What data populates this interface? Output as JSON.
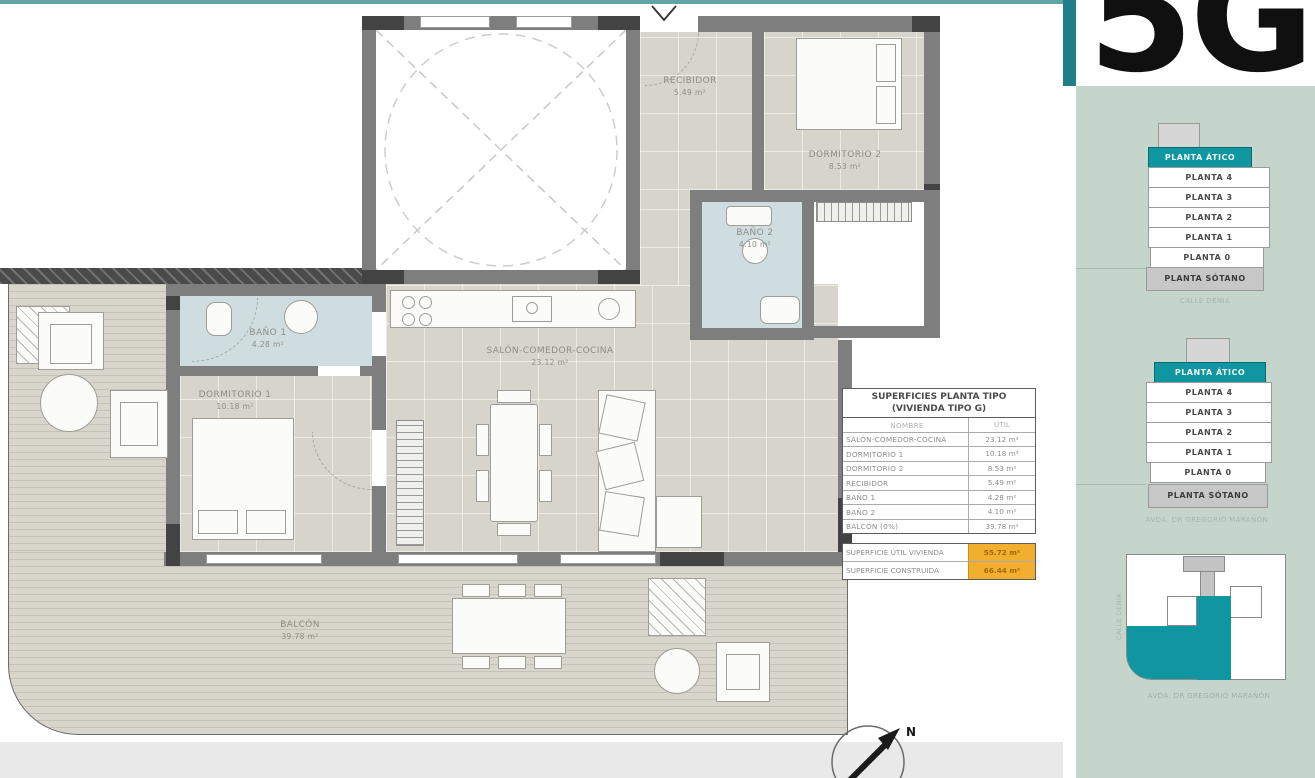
{
  "unit": {
    "code": "5G"
  },
  "plan": {
    "rooms": {
      "salon": {
        "label": "SALÓN-COMEDOR-COCINA",
        "area": "23.12 m²"
      },
      "dormitorio1": {
        "label": "DORMITORIO 1",
        "area": "10.18 m²"
      },
      "dormitorio2": {
        "label": "DORMITORIO 2",
        "area": "8.53 m²"
      },
      "recibidor": {
        "label": "RECIBIDOR",
        "area": "5.49 m²"
      },
      "bano1": {
        "label": "BAÑO 1",
        "area": "4.28 m²"
      },
      "bano2": {
        "label": "BAÑO 2",
        "area": "4.10 m²"
      },
      "balcon": {
        "label": "BALCÓN",
        "area": "39.78 m²"
      }
    },
    "compass_label": "N"
  },
  "surfaces_table": {
    "title_line1": "SUPERFICIES PLANTA TIPO",
    "title_line2": "(VIVIENDA TIPO G)",
    "col_name": "NOMBRE",
    "col_util": "ÚTIL",
    "rows": [
      {
        "name": "SALÓN-COMEDOR-COCINA",
        "util": "23.12 m²"
      },
      {
        "name": "DORMITORIO 1",
        "util": "10.18 m²"
      },
      {
        "name": "DORMITORIO 2",
        "util": "8.53 m²"
      },
      {
        "name": "RECIBIDOR",
        "util": "5.49 m²"
      },
      {
        "name": "BAÑO 1",
        "util": "4.28 m²"
      },
      {
        "name": "BAÑO 2",
        "util": "4.10 m²"
      },
      {
        "name": "BALCÓN (0%)",
        "util": "39.78 m²"
      }
    ],
    "totals": [
      {
        "name": "SUPERFICIE ÚTIL VIVIENDA",
        "value": "55.72 m²"
      },
      {
        "name": "SUPERFICIE CONSTRUIDA",
        "value": "66.44 m²"
      }
    ]
  },
  "sidebar": {
    "stack1": {
      "atico": "PLANTA ÁTICO",
      "floors": [
        "PLANTA 4",
        "PLANTA 3",
        "PLANTA 2",
        "PLANTA 1",
        "PLANTA 0"
      ],
      "sotano": "PLANTA SÓTANO",
      "caption": "CALLE DENIA"
    },
    "stack2": {
      "atico": "PLANTA ÁTICO",
      "floors": [
        "PLANTA 4",
        "PLANTA 3",
        "PLANTA 2",
        "PLANTA 1",
        "PLANTA 0"
      ],
      "sotano": "PLANTA SÓTANO",
      "caption": "AVDA. DR GREGORIO MARAÑÓN"
    },
    "siteplan": {
      "street_left": "CALLE DENIA",
      "street_bottom": "AVDA. DR GREGORIO MARAÑÓN"
    }
  },
  "colors": {
    "teal": "#0f96a0",
    "sage": "#c6d5cc",
    "amber": "#f2ae2e"
  }
}
